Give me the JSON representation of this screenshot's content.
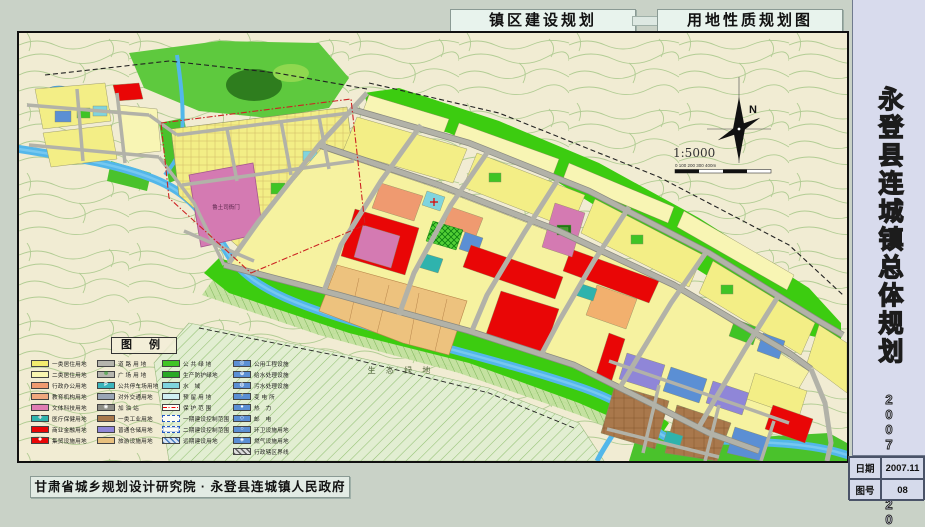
{
  "header": {
    "title_left": "镇区建设规划",
    "title_right": "用地性质规划图"
  },
  "sidebar": {
    "title": "永登县连城镇总体规划",
    "years": "2007—2020"
  },
  "footer": {
    "credit": "甘肃省城乡规划设计研究院 · 永登县连城镇人民政府",
    "date_label": "日期",
    "date_value": "2007.11",
    "sheet_label": "图号",
    "sheet_value": "08"
  },
  "map": {
    "labels": {
      "historic_site": "鲁土司衙门",
      "eco_green": "生 态 绿 地"
    },
    "compass": {
      "north": "N",
      "scale": "1:5000",
      "scalebar": "0     100    200    300   400m"
    },
    "legend": {
      "title": "图 例",
      "columns": [
        [
          {
            "label": "一类居住用地",
            "type": "solid",
            "color": "#f2ec6e"
          },
          {
            "label": "二类居住用地",
            "type": "solid",
            "color": "#f8f5b0"
          },
          {
            "label": "行政办公用地",
            "type": "solid",
            "color": "#ef9a70"
          },
          {
            "label": "教育机构用地",
            "type": "solid",
            "color": "#f0a87e"
          },
          {
            "label": "文体科技用地",
            "type": "solid",
            "color": "#e07cb4"
          },
          {
            "label": "医疗保健用地",
            "type": "solid",
            "color": "#2fb3ad",
            "symbol": "✚",
            "symbol_color": "#ffe2e2"
          },
          {
            "label": "商业金融用地",
            "type": "solid",
            "color": "#e90606"
          },
          {
            "label": "集贸设施用地",
            "type": "solid",
            "color": "#e90606",
            "symbol": "✹",
            "symbol_color": "#ffffff"
          }
        ],
        [
          {
            "label": "道 路 用 地",
            "type": "solid",
            "color": "#b5b5ad"
          },
          {
            "label": "广 场 用 地",
            "type": "solid",
            "color": "#b5b5ad",
            "symbol": "❉",
            "symbol_color": "#1e9e1e"
          },
          {
            "label": "公共停车场用地",
            "type": "solid",
            "color": "#3ab4bc",
            "symbol": "P",
            "symbol_color": "#ffffff"
          },
          {
            "label": "对外交通用地",
            "type": "solid",
            "color": "#9aa6b6"
          },
          {
            "label": "加 油 站",
            "type": "solid",
            "color": "#8e8e86",
            "symbol": "◉",
            "symbol_color": "#ffffff"
          },
          {
            "label": "一类工业用地",
            "type": "solid",
            "color": "#a9784c"
          },
          {
            "label": "普通仓储用地",
            "type": "solid",
            "color": "#8f86d8"
          },
          {
            "label": "旅游设施用地",
            "type": "solid",
            "color": "#e8c07e"
          }
        ],
        [
          {
            "label": "公 共 绿 地",
            "type": "solid",
            "color": "#3fc425"
          },
          {
            "label": "生产防护绿地",
            "type": "solid",
            "color": "#2aa826"
          },
          {
            "label": "水　域",
            "type": "solid",
            "color": "#7fd4de"
          },
          {
            "label": "预 留 用 地",
            "type": "solid",
            "color": "#cfeef2"
          },
          {
            "label": "保 护 范 围",
            "type": "line-red",
            "color": "#fdfdf6"
          },
          {
            "label": "一期建设控制范围",
            "type": "box-dashed-blue",
            "color": "#fdfdf6"
          },
          {
            "label": "二期建设控制范围",
            "type": "box-dashdot-blue",
            "color": "#fdfdf6"
          },
          {
            "label": "远期建设用地",
            "type": "hatch-blue",
            "color": "#d9e5f5"
          }
        ],
        [
          {
            "label": "公用工程设施",
            "type": "solid",
            "color": "#5b8fd4",
            "symbol": "◎",
            "symbol_color": "#ffffff"
          },
          {
            "label": "给水处理设施",
            "type": "solid",
            "color": "#5b8fd4",
            "symbol": "⊕",
            "symbol_color": "#ffffff"
          },
          {
            "label": "污水处理设施",
            "type": "solid",
            "color": "#5b8fd4",
            "symbol": "◍",
            "symbol_color": "#ffffff"
          },
          {
            "label": "变 电 所",
            "type": "solid",
            "color": "#5b8fd4",
            "symbol": "⚡",
            "symbol_color": "#ffe27a"
          },
          {
            "label": "热　力",
            "type": "solid",
            "color": "#5b8fd4",
            "symbol": "●",
            "symbol_color": "#ffffff"
          },
          {
            "label": "邮　电",
            "type": "solid",
            "color": "#5b8fd4",
            "symbol": "◇",
            "symbol_color": "#ffffff"
          },
          {
            "label": "环卫设施用地",
            "type": "solid",
            "color": "#5b8fd4",
            "symbol": "○",
            "symbol_color": "#ffffff"
          },
          {
            "label": "燃气设施用地",
            "type": "solid",
            "color": "#5b8fd4",
            "symbol": "◈",
            "symbol_color": "#ffffff"
          },
          {
            "label": "行政辖区界线",
            "type": "hatch-gray",
            "color": "#dddddd"
          }
        ]
      ]
    }
  }
}
